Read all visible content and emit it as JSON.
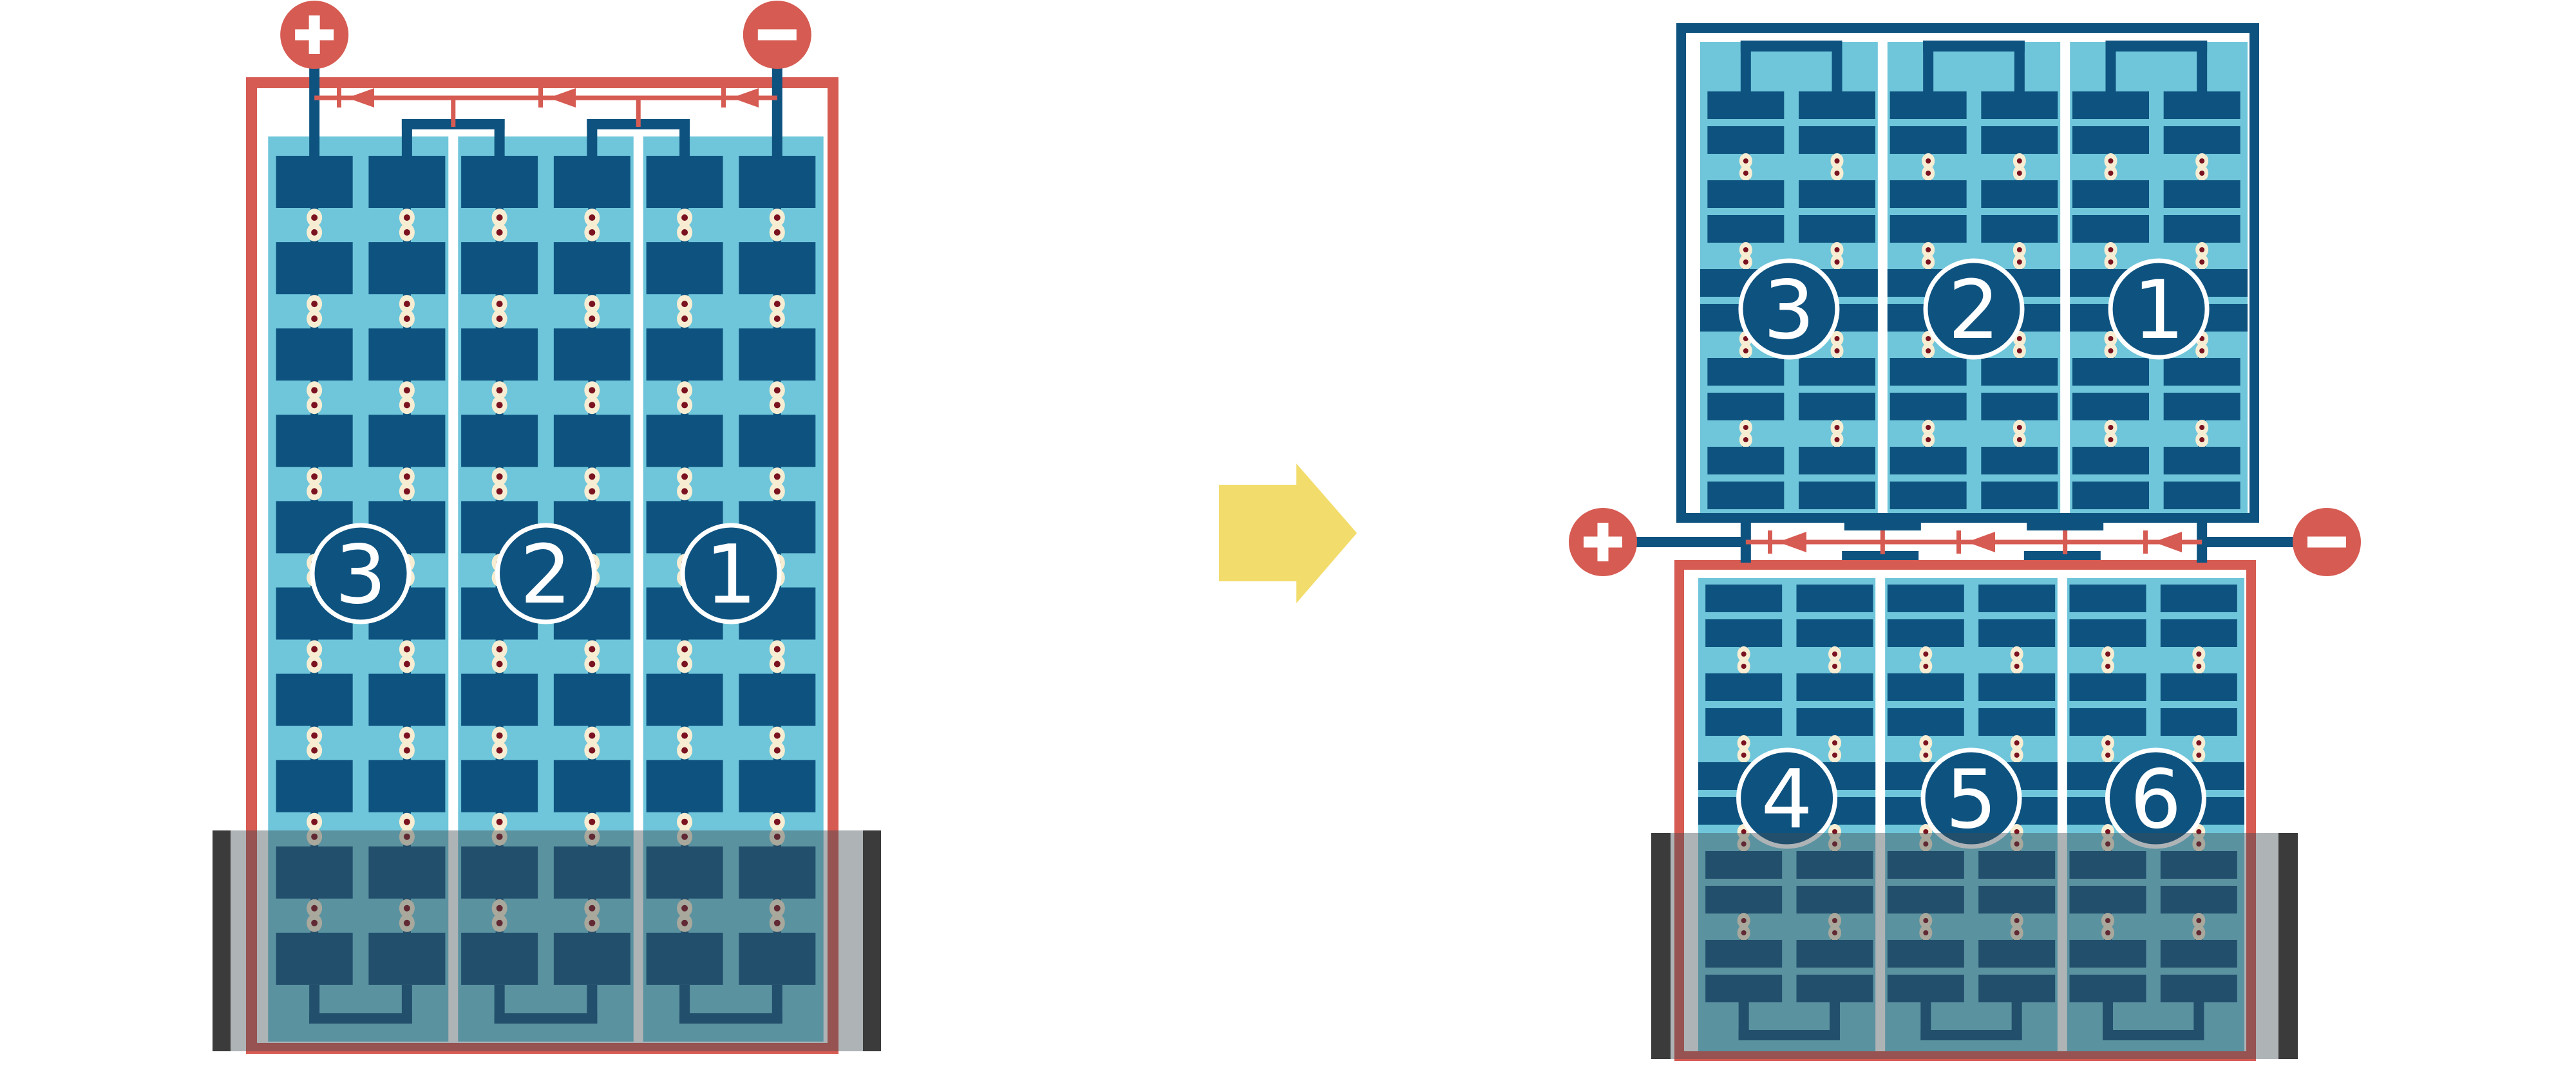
{
  "diagram": {
    "description": "Solar PV module wiring comparison: full-cell module (left) transformed into half-cut module (right) with mid-panel junction; bottom rows shaded",
    "arrow": {
      "meaning": "transforms-into",
      "direction": "right"
    }
  },
  "colors": {
    "red": "#D65B52",
    "navy": "#0E5380",
    "light_blue": "#6FC6DA",
    "cream": "#F7EDD3",
    "maroon": "#7A1220",
    "white": "#FFFFFF",
    "overlay": "rgba(62,74,82,0.42)",
    "overlay_cap": "#3B3B3B",
    "arrow_yellow": "#F2DC6B",
    "number_text": "#FFFFFF"
  },
  "left_module": {
    "name": "full-cell-module",
    "frame_color": "#D65B52",
    "sections": [
      {
        "label": "3"
      },
      {
        "label": "2"
      },
      {
        "label": "1"
      }
    ],
    "terminals": {
      "positive_symbol": "+",
      "negative_symbol": "−"
    },
    "bypass_diode_count": 3,
    "shading": "bottom rows shaded"
  },
  "right_assembly": {
    "name": "half-cut-module",
    "top_module": {
      "frame_color": "#0E5380",
      "sections": [
        {
          "label": "3"
        },
        {
          "label": "2"
        },
        {
          "label": "1"
        }
      ]
    },
    "bottom_module": {
      "frame_color": "#D65B52",
      "sections": [
        {
          "label": "4"
        },
        {
          "label": "5"
        },
        {
          "label": "6"
        }
      ]
    },
    "terminals": {
      "positive_symbol": "+",
      "negative_symbol": "−"
    },
    "bypass_diode_count": 3,
    "shading": "bottom rows shaded"
  }
}
